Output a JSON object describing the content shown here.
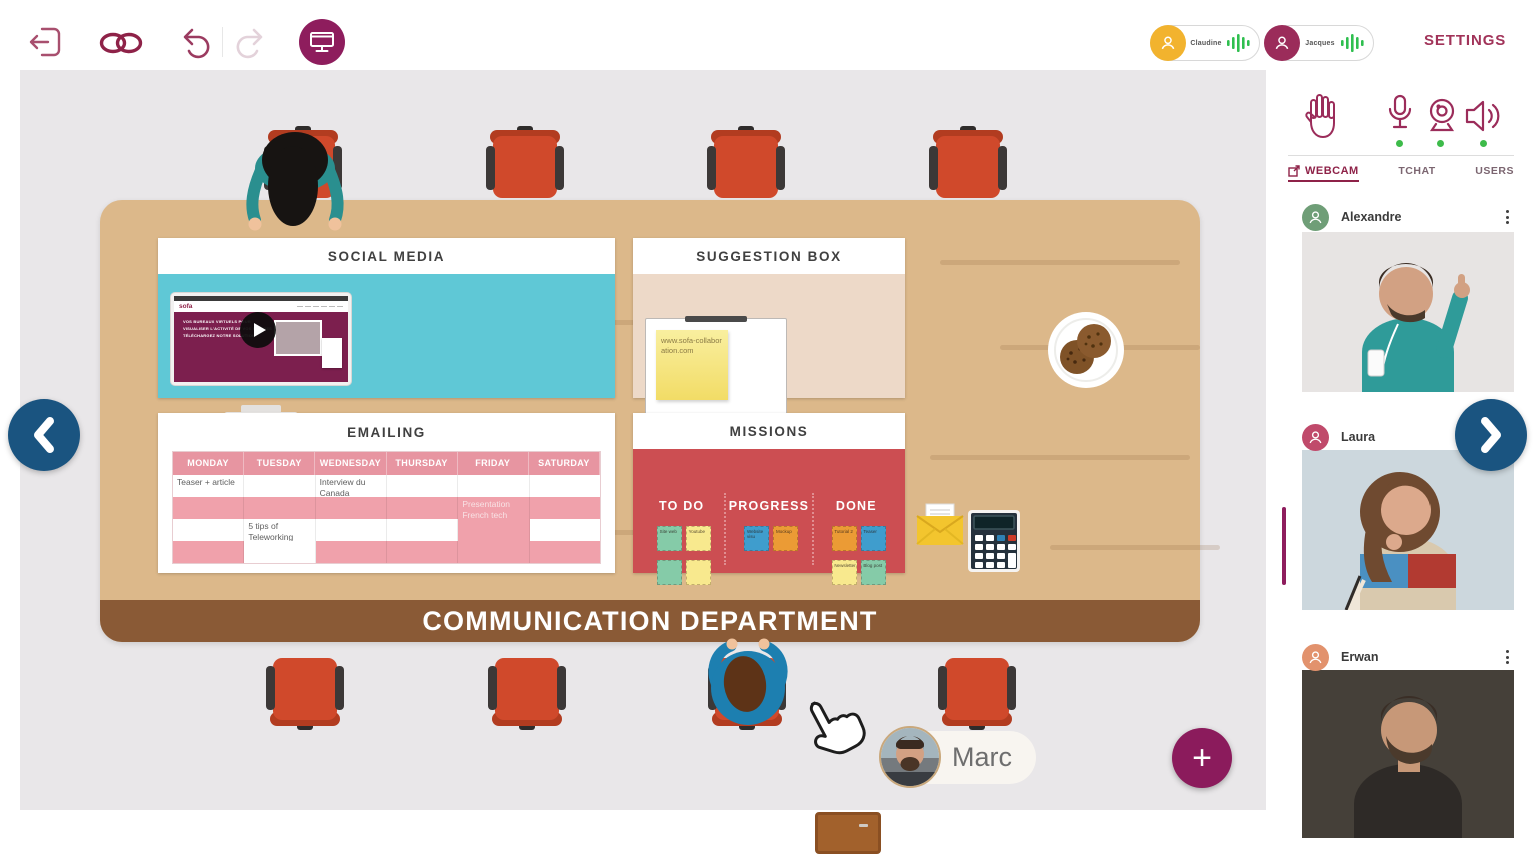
{
  "app": {
    "settings_label": "SETTINGS"
  },
  "topbar": {
    "voice_chips": [
      {
        "name": "Claudine",
        "avatar_color": "#f2b32e"
      },
      {
        "name": "Jacques",
        "avatar_color": "#9b2c5a"
      }
    ]
  },
  "sidebar": {
    "tabs": [
      {
        "label": "WEBCAM",
        "active": true
      },
      {
        "label": "TCHAT",
        "active": false
      },
      {
        "label": "USERS",
        "active": false
      }
    ],
    "participants": [
      {
        "name": "Alexandre",
        "avatar_color": "#6f9e77"
      },
      {
        "name": "Laura",
        "avatar_color": "#c04a6b"
      },
      {
        "name": "Erwan",
        "avatar_color": "#e2926d"
      }
    ]
  },
  "room": {
    "banner": "COMMUNICATION DEPARTMENT",
    "current_user": {
      "name": "Marc"
    }
  },
  "boards": {
    "social_media": {
      "title": "SOCIAL MEDIA",
      "site_logo": "sofa",
      "hero_lines": [
        "VOS BUREAUX VIRTUELS POUR",
        "VISUALISER L'ACTIVITÉ DE VOS ÉQUIPES",
        "TÉLÉCHARGEZ NOTRE SOLUTION"
      ]
    },
    "suggestion_box": {
      "title": "SUGGESTION BOX",
      "note": "www.sofa-collaboration.com"
    },
    "emailing": {
      "title": "EMAILING",
      "columns": [
        "MONDAY",
        "TUESDAY",
        "WEDNESDAY",
        "THURSDAY",
        "FRIDAY",
        "SATURDAY"
      ],
      "rows": [
        {
          "bg": "light",
          "cells": [
            {
              "text": "Teaser + article"
            },
            {
              "text": ""
            },
            {
              "text": "Interview du Canada"
            },
            {
              "text": ""
            },
            {
              "text": ""
            },
            {
              "text": ""
            }
          ]
        },
        {
          "bg": "pink",
          "cells": [
            {
              "text": ""
            },
            {
              "text": ""
            },
            {
              "text": ""
            },
            {
              "text": ""
            },
            {
              "text": "Presentation French tech",
              "bg": "pink"
            },
            {
              "text": ""
            }
          ]
        },
        {
          "bg": "light",
          "cells": [
            {
              "text": ""
            },
            {
              "text": "5 tips of Teleworking"
            },
            {
              "text": ""
            },
            {
              "text": ""
            },
            {
              "text": "",
              "bg": "pink"
            },
            {
              "text": ""
            }
          ]
        },
        {
          "bg": "pink",
          "cells": [
            {
              "text": ""
            },
            {
              "text": "",
              "bg": "light"
            },
            {
              "text": ""
            },
            {
              "text": ""
            },
            {
              "text": ""
            },
            {
              "text": ""
            }
          ]
        }
      ]
    },
    "missions": {
      "title": "MISSIONS",
      "columns": [
        {
          "label": "TO DO",
          "notes": [
            {
              "text": "Site web",
              "color": "green"
            },
            {
              "text": "Youtube",
              "color": "yellow"
            },
            {
              "text": "",
              "color": "green"
            },
            {
              "text": "",
              "color": "yellow"
            }
          ]
        },
        {
          "label": "PROGRESS",
          "notes": [
            {
              "text": "Website visu",
              "color": "blue"
            },
            {
              "text": "Mockup",
              "color": "orange"
            }
          ]
        },
        {
          "label": "DONE",
          "notes": [
            {
              "text": "Tutorial 2",
              "color": "orange"
            },
            {
              "text": "Teaser",
              "color": "blue"
            },
            {
              "text": "Newsletter",
              "color": "yellow"
            },
            {
              "text": "Blog post",
              "color": "green"
            }
          ]
        }
      ]
    }
  },
  "icons": {
    "toolbar": [
      "exit-icon",
      "link-icon",
      "undo-icon",
      "redo-icon",
      "present-screen-icon"
    ],
    "sidebar_controls": [
      "raise-hand-icon",
      "mic-icon",
      "webcam-icon",
      "speaker-icon"
    ],
    "plus_glyph": "+"
  },
  "colors": {
    "accent_maroon": "#8e2248",
    "accent_dark": "#8e1d5d",
    "nav_blue": "#1a5480",
    "online_green": "#3dbb4a",
    "desk_wood": "#dcb88a",
    "banner_brown": "#8a5a36",
    "board_teal": "#5fc8d6",
    "board_beige": "#edd9c8",
    "board_red": "#cc4e52",
    "table_pink": "#f0a1ab"
  }
}
